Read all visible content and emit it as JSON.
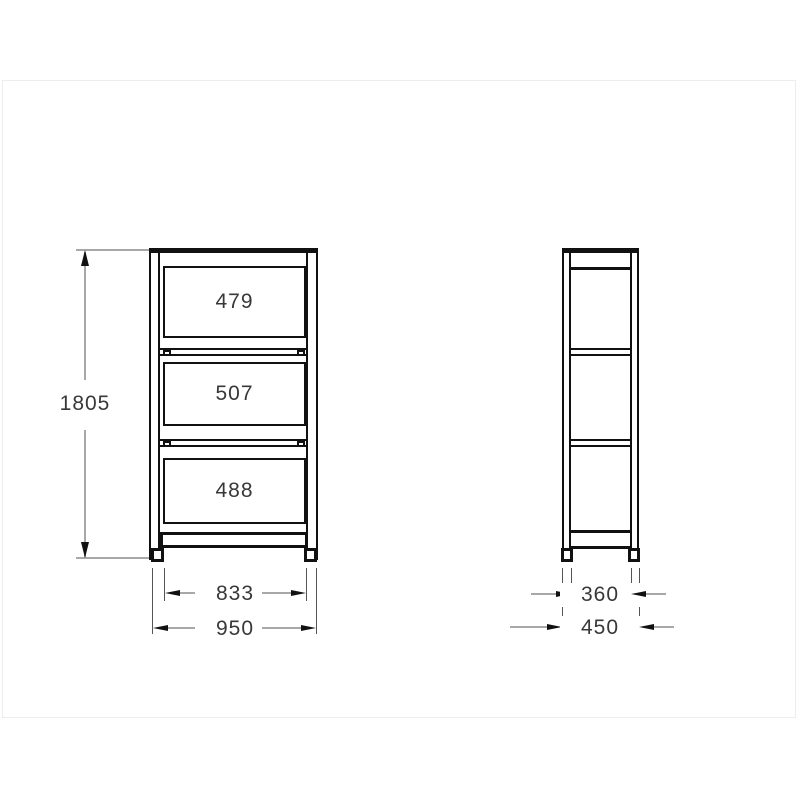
{
  "front_view": {
    "shelf_gaps": [
      {
        "label": "479"
      },
      {
        "label": "507"
      },
      {
        "label": "488"
      }
    ],
    "height": "1805",
    "inner_width": "833",
    "overall_width": "950"
  },
  "side_view": {
    "inner_depth": "360",
    "overall_depth": "450"
  },
  "colors": {
    "line": "#111111",
    "dimension_line": "#a8a8a8",
    "extension_line": "#555555",
    "text": "#383838",
    "frame_border": "#ededed"
  }
}
